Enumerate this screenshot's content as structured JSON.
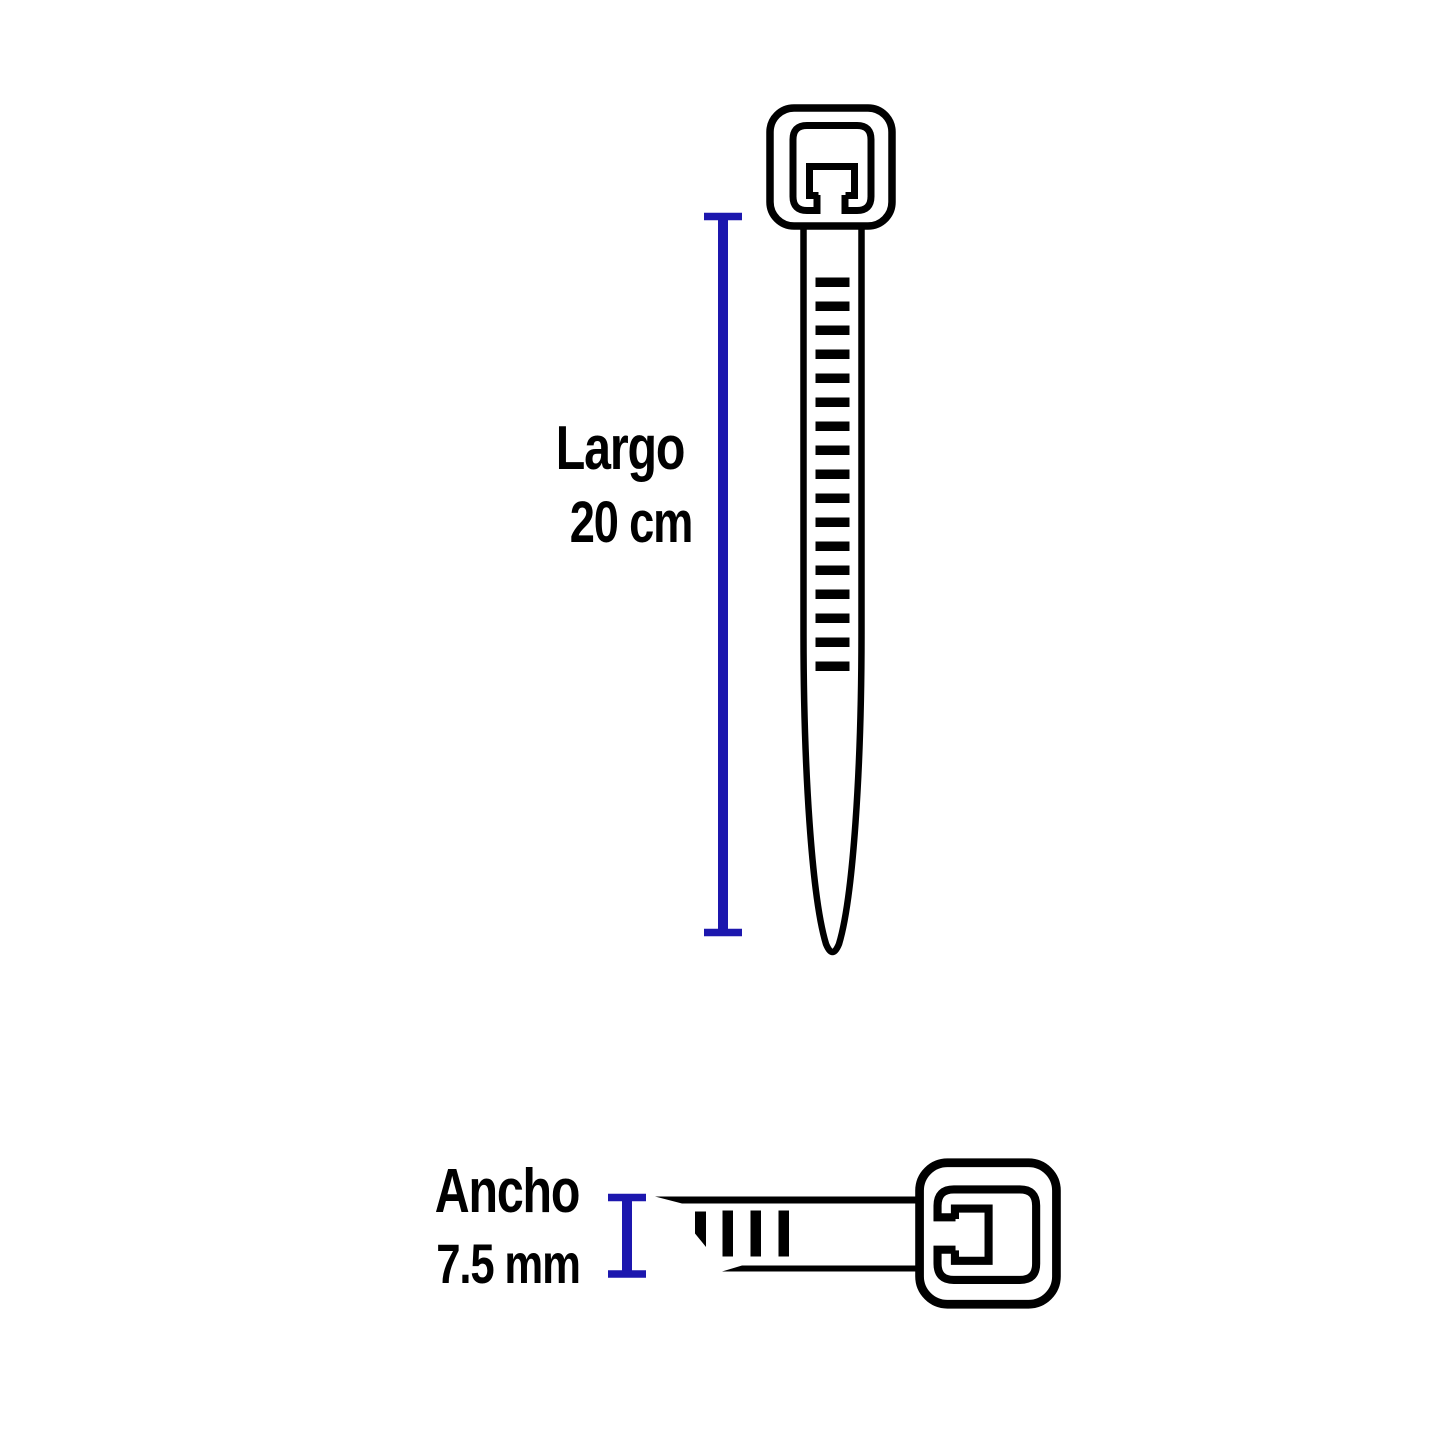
{
  "diagram": {
    "product": "cable-tie",
    "length": {
      "label": "Largo",
      "value": "20 cm"
    },
    "width": {
      "label": "Ancho",
      "value": "7.5 mm"
    }
  },
  "colors": {
    "line_black": "#000000",
    "measurement_blue": "#1c17ae",
    "background": "#ffffff"
  }
}
